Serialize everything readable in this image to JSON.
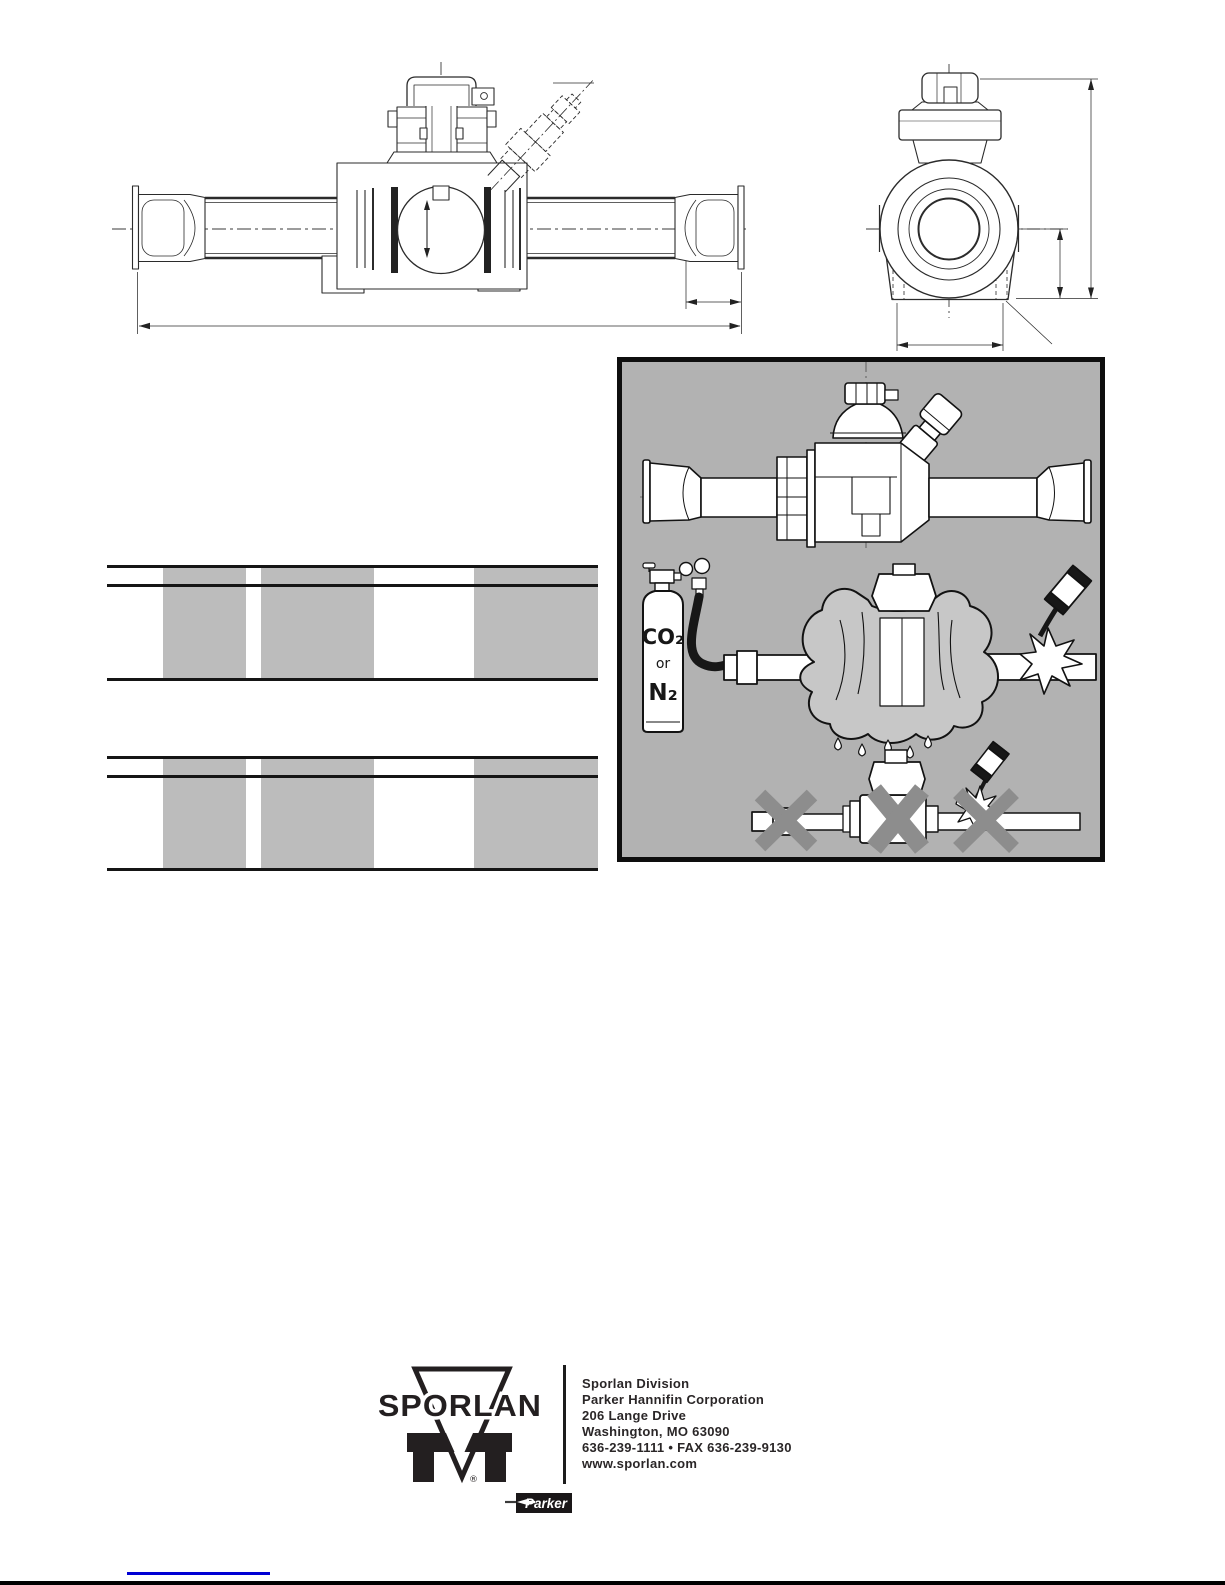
{
  "illustrations": {
    "cylinder_labels": {
      "top": "CO₂",
      "middle": "or",
      "bottom": "N₂"
    }
  },
  "footer": {
    "brand": "SPORLAN",
    "registered_mark": "®",
    "address_lines": [
      "Sporlan Division",
      "Parker Hannifin Corporation",
      "206 Lange Drive",
      "Washington, MO 63090",
      "636-239-1111  •  FAX 636-239-9130",
      "www.sporlan.com"
    ],
    "parker_label": "Parker"
  },
  "colors": {
    "panel_background": "#b2b2b2",
    "table_band": "#bcbcbc",
    "x_mark": "#8d8d8d",
    "link_blue": "#0000d4",
    "ink": "#161616"
  }
}
